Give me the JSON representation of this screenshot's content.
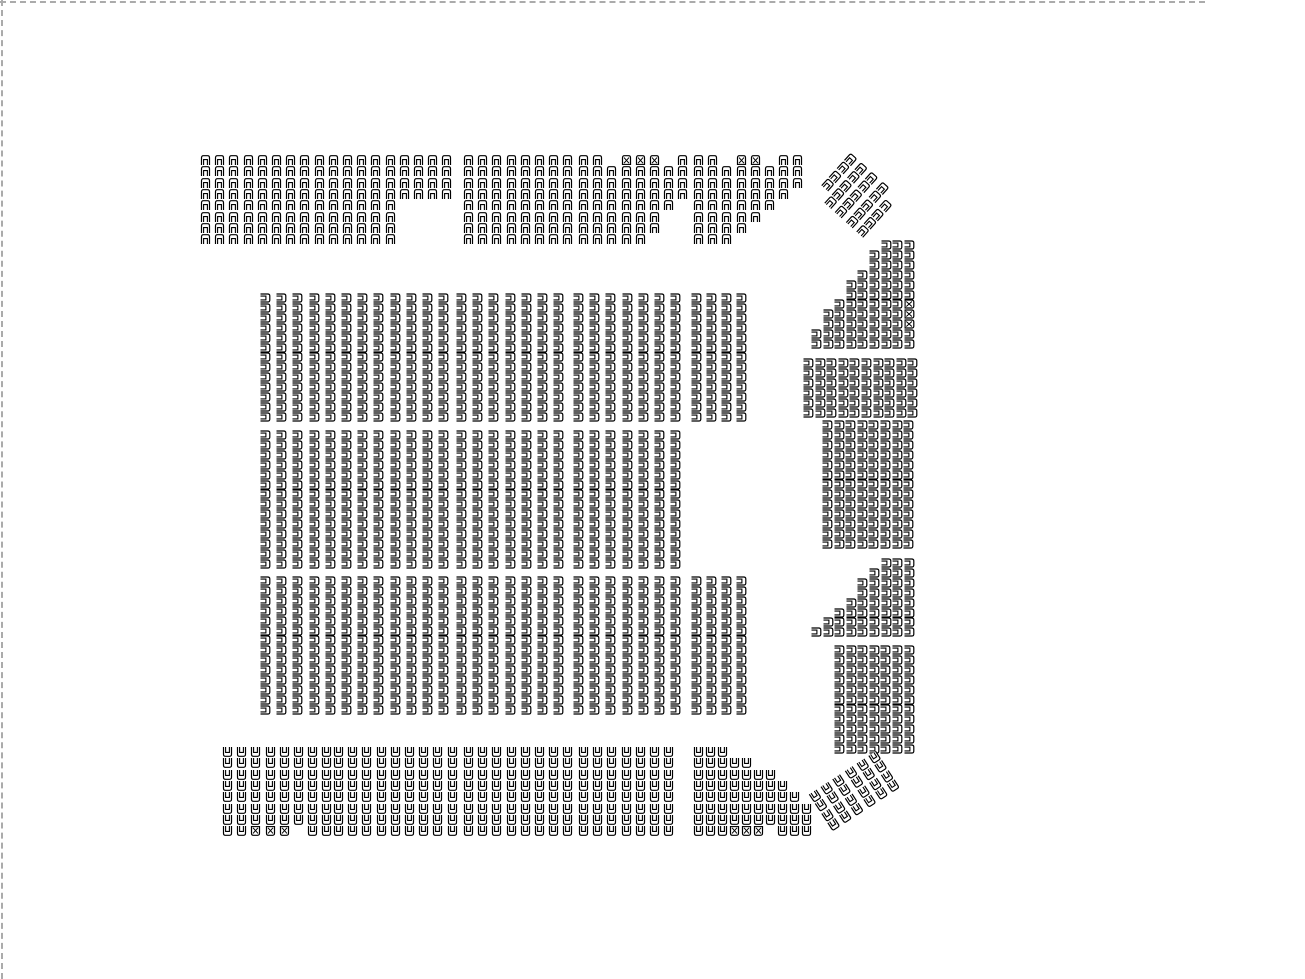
{
  "page": {
    "title": "Venue seating map",
    "background": "#ffffff",
    "boundary_style": "dashed",
    "boundary_color": "#ababab"
  },
  "icons": {
    "seat": "seat-icon",
    "wheelchair_seat": "wheelchair-seat-icon"
  },
  "seat_style": {
    "stroke": "#000000",
    "fill": "#ffffff",
    "width": 11,
    "height": 10
  },
  "legend": {
    "N": "standard-seat",
    "W": "restricted-or-accessible-seat",
    ".": "empty-space"
  },
  "sections": [
    {
      "id": "upper-left",
      "orientation": "down",
      "x": 200,
      "y": 155,
      "colSpacing": 14.2,
      "rowSpacing": 11.3,
      "rows": [
        "NNNNNNNNNNNNNNNNNN",
        "NNNNNNNNNNNNNNNNNN",
        "NNNNNNNNNNNNNNNNNN",
        "NNNNNNNNNNNNNNNNNN",
        "NNNNNNNNNNNNNN",
        "NNNNNNNNNNNNNN",
        "NNNNNNNNNNNNNN",
        "NNNNNNNNNNNNNN"
      ]
    },
    {
      "id": "upper-center",
      "orientation": "down",
      "x": 463,
      "y": 155,
      "colSpacing": 14.2,
      "rowSpacing": 11.3,
      "rows": [
        "NNNNNNNN",
        "NNNNNNNN",
        "NNNNNNNN",
        "NNNNNNNN",
        "NNNNNNNN",
        "NNNNNNNN",
        "NNNNNNNN",
        "NNNNNNNN"
      ]
    },
    {
      "id": "upper-right-a",
      "orientation": "down",
      "x": 578,
      "y": 155,
      "colSpacing": 14.2,
      "rowSpacing": 11.3,
      "rows": [
        "NN.WWW.N",
        "NNNNNNNN",
        "NNNNNNNN",
        "NNNNNNNN",
        "NNNNNNN.",
        "NNNNNN..",
        "NNNNNN..",
        "NNNNN..."
      ]
    },
    {
      "id": "upper-right-b",
      "orientation": "down",
      "x": 693,
      "y": 155,
      "colSpacing": 14.2,
      "rowSpacing": 11.3,
      "rows": [
        "NN.WW.NN",
        "NNNNNNNN",
        "NNNNNNNN",
        "NNNNNNN.",
        "NNNNNN..",
        "NNNNN...",
        "NNNN....",
        "NNN....."
      ]
    },
    {
      "id": "upper-corner-diagonal",
      "orientation": "down",
      "x": 850,
      "y": 152,
      "rotate": 42,
      "colSpacing": 14.2,
      "rowSpacing": 11.3,
      "rows": [
        "NNNN.",
        "NNNNN",
        "NNNNN",
        "NNNNN",
        ".NNNN"
      ]
    },
    {
      "id": "right-tier-1",
      "orientation": "left",
      "x": 811,
      "y": 240,
      "colSpacing": 11.6,
      "rowSpacing": 9.9,
      "rows": [
        "......NNN",
        ".....NNNN",
        ".....NNNN",
        "....NNNNN",
        "...NNNNNN",
        "...NNNNNN",
        "..NNNNNNW",
        ".NNNNNNNW",
        ".NNNNNNNW",
        "NNNNNNNNN",
        "NNNNNNNNN"
      ]
    },
    {
      "id": "right-tier-2",
      "orientation": "left",
      "x": 803,
      "y": 358,
      "colSpacing": 11.6,
      "rowSpacing": 9.9,
      "rows": [
        "NNNNNNNNNN",
        "NNNNNNNNNN",
        "NNNNNNNNNN",
        "NNNNNNNNNN",
        "NNNNNNNNNN",
        "NNNNNNNNNN"
      ]
    },
    {
      "id": "right-tier-3",
      "orientation": "left",
      "x": 822,
      "y": 420,
      "colSpacing": 11.6,
      "rowSpacing": 9.9,
      "rows": [
        "NNNNNNNN",
        "NNNNNNNN",
        "NNNNNNNN",
        "NNNNNNNN",
        "NNNNNNNN",
        "NNNNNNNN",
        "NNNNNNNN",
        "NNNNNNNN",
        "NNNNNNNN",
        "NNNNNNNN",
        "NNNNNNNN",
        "NNNNNNNN",
        "NNNNNNNN"
      ]
    },
    {
      "id": "right-tier-4",
      "orientation": "left",
      "x": 811,
      "y": 558,
      "colSpacing": 11.6,
      "rowSpacing": 9.9,
      "rows": [
        "......NNN",
        ".....NNNN",
        "....NNNNN",
        "....NNNNN",
        "...NNNNNN",
        "..NNNNNNN",
        ".NNNNNNNN",
        "NNNNNNNNN"
      ]
    },
    {
      "id": "right-tier-5",
      "orientation": "left",
      "x": 834,
      "y": 645,
      "colSpacing": 11.6,
      "rowSpacing": 9.9,
      "rows": [
        "NNNNNNN",
        "NNNNNNN",
        "NNNNNNN",
        "NNNNNNN",
        "NNNNNNN",
        "NNNNNNN",
        "NNNNNNN",
        "NNNNNNN",
        "NNNNNNN",
        "NNNNNNN",
        "NNNNNNN"
      ]
    },
    {
      "id": "floor-a1",
      "orientation": "left",
      "x": 260,
      "y": 293,
      "colSpacing": 16.2,
      "rowSpacing": 9.9,
      "rows": [
        "NNNNNNNNNNNN",
        "NNNNNNNNNNNN",
        "NNNNNNNNNNNN",
        "NNNNNNNNNNNN",
        "NNNNNNNNNNNN",
        "NNNNNNNNNNNN",
        "NNNNNNNNNNNN",
        "NNNNNNNNNNNN",
        "NNNNNNNNNNNN",
        "NNNNNNNNNNNN",
        "NNNNNNNNNNNN",
        "NNNNNNNNNNNN",
        "NNNNNNNNNNNN"
      ]
    },
    {
      "id": "floor-a2",
      "orientation": "left",
      "x": 456,
      "y": 293,
      "colSpacing": 16.2,
      "rowSpacing": 9.9,
      "rows": [
        "NNNNNNN",
        "NNNNNNN",
        "NNNNNNN",
        "NNNNNNN",
        "NNNNNNN",
        "NNNNNNN",
        "NNNNNNN",
        "NNNNNNN",
        "NNNNNNN",
        "NNNNNNN",
        "NNNNNNN",
        "NNNNNNN",
        "NNNNNNN"
      ]
    },
    {
      "id": "floor-a3",
      "orientation": "left",
      "x": 573,
      "y": 293,
      "colSpacing": 16.2,
      "rowSpacing": 9.9,
      "rows": [
        "NNNNNNN",
        "NNNNNNN",
        "NNNNNNN",
        "NNNNNNN",
        "NNNNNNN",
        "NNNNNNN",
        "NNNNNNN",
        "NNNNNNN",
        "NNNNNNN",
        "NNNNNNN",
        "NNNNNNN",
        "NNNNNNN",
        "NNNNNNN"
      ]
    },
    {
      "id": "floor-a4",
      "orientation": "left",
      "x": 691,
      "y": 293,
      "colSpacing": 15,
      "rowSpacing": 9.9,
      "rows": [
        "NNNN",
        "NNNN",
        "NNNN",
        "NNNN",
        "NNNN",
        "NNNN",
        "NNNN",
        "NNNN",
        "NNNN",
        "NNNN",
        "NNNN",
        "NNNN",
        "NNNN"
      ]
    },
    {
      "id": "floor-b1",
      "orientation": "left",
      "x": 260,
      "y": 430,
      "colSpacing": 16.2,
      "rowSpacing": 9.9,
      "rows": [
        "NNNNNNNNNNNN",
        "NNNNNNNNNNNN",
        "NNNNNNNNNNNN",
        "NNNNNNNNNNNN",
        "NNNNNNNNNNNN",
        "NNNNNNNNNNNN",
        "NNNNNNNNNNNN",
        "NNNNNNNNNNNN",
        "NNNNNNNNNNNN",
        "NNNNNNNNNNNN",
        "NNNNNNNNNNNN",
        "NNNNNNNNNNNN",
        "NNNNNNNNNNNN",
        "NNNNNNNNNNNN"
      ]
    },
    {
      "id": "floor-b2",
      "orientation": "left",
      "x": 456,
      "y": 430,
      "colSpacing": 16.2,
      "rowSpacing": 9.9,
      "rows": [
        "NNNNNNN",
        "NNNNNNN",
        "NNNNNNN",
        "NNNNNNN",
        "NNNNNNN",
        "NNNNNNN",
        "NNNNNNN",
        "NNNNNNN",
        "NNNNNNN",
        "NNNNNNN",
        "NNNNNNN",
        "NNNNNNN",
        "NNNNNNN",
        "NNNNNNN"
      ]
    },
    {
      "id": "floor-b3",
      "orientation": "left",
      "x": 573,
      "y": 430,
      "colSpacing": 16.2,
      "rowSpacing": 9.9,
      "rows": [
        "NNNNNNN",
        "NNNNNNN",
        "NNNNNNN",
        "NNNNNNN",
        "NNNNNNN",
        "NNNNNNN",
        "NNNNNNN",
        "NNNNNNN",
        "NNNNNNN",
        "NNNNNNN",
        "NNNNNNN",
        "NNNNNNN",
        "NNNNNNN",
        "NNNNNNN"
      ]
    },
    {
      "id": "floor-c1",
      "orientation": "left",
      "x": 260,
      "y": 576,
      "colSpacing": 16.2,
      "rowSpacing": 9.9,
      "rows": [
        "NNNNNNNNNNNN",
        "NNNNNNNNNNNN",
        "NNNNNNNNNNNN",
        "NNNNNNNNNNNN",
        "NNNNNNNNNNNN",
        "NNNNNNNNNNNN",
        "NNNNNNNNNNNN",
        "NNNNNNNNNNNN",
        "NNNNNNNNNNNN",
        "NNNNNNNNNNNN",
        "NNNNNNNNNNNN",
        "NNNNNNNNNNNN",
        "NNNNNNNNNNNN",
        "NNNNNNNNNNNN"
      ]
    },
    {
      "id": "floor-c2",
      "orientation": "left",
      "x": 456,
      "y": 576,
      "colSpacing": 16.2,
      "rowSpacing": 9.9,
      "rows": [
        "NNNNNNN",
        "NNNNNNN",
        "NNNNNNN",
        "NNNNNNN",
        "NNNNNNN",
        "NNNNNNN",
        "NNNNNNN",
        "NNNNNNN",
        "NNNNNNN",
        "NNNNNNN",
        "NNNNNNN",
        "NNNNNNN",
        "NNNNNNN",
        "NNNNNNN"
      ]
    },
    {
      "id": "floor-c3",
      "orientation": "left",
      "x": 573,
      "y": 576,
      "colSpacing": 16.2,
      "rowSpacing": 9.9,
      "rows": [
        "NNNNNNN",
        "NNNNNNN",
        "NNNNNNN",
        "NNNNNNN",
        "NNNNNNN",
        "NNNNNNN",
        "NNNNNNN",
        "NNNNNNN",
        "NNNNNNN",
        "NNNNNNN",
        "NNNNNNN",
        "NNNNNNN",
        "NNNNNNN",
        "NNNNNNN"
      ]
    },
    {
      "id": "floor-c4",
      "orientation": "left",
      "x": 691,
      "y": 576,
      "colSpacing": 15,
      "rowSpacing": 9.9,
      "rows": [
        "NNNN",
        "NNNN",
        "NNNN",
        "NNNN",
        "NNNN",
        "NNNN",
        "NNNN",
        "NNNN",
        "NNNN",
        "NNNN",
        "NNNN",
        "NNNN",
        "NNNN",
        "NNNN"
      ]
    },
    {
      "id": "lower-left",
      "orientation": "up",
      "x": 222,
      "y": 747,
      "colSpacing": 14.2,
      "rowSpacing": 11.3,
      "rows": [
        "NNNNNNNN",
        "NNNNNNNN",
        "NNNNNNNN",
        "NNNNNNNN",
        "NNNNNNNN",
        "NNNNNNNN",
        "NNNNNNNN",
        "NNWWW.NN"
      ]
    },
    {
      "id": "lower-center-a",
      "orientation": "up",
      "x": 333,
      "y": 747,
      "colSpacing": 14.2,
      "rowSpacing": 11.3,
      "rows": [
        "NNNNNNNNN",
        "NNNNNNNNN",
        "NNNNNNNNN",
        "NNNNNNNNN",
        "NNNNNNNNN",
        "NNNNNNNNN",
        "NNNNNNNNN",
        "NNNNNNNNN"
      ]
    },
    {
      "id": "lower-center-b",
      "orientation": "up",
      "x": 463,
      "y": 747,
      "colSpacing": 14.2,
      "rowSpacing": 11.3,
      "rows": [
        "NNNNNNNN",
        "NNNNNNNN",
        "NNNNNNNN",
        "NNNNNNNN",
        "NNNNNNNN",
        "NNNNNNNN",
        "NNNNNNNN",
        "NNNNNNNN"
      ]
    },
    {
      "id": "lower-center-c",
      "orientation": "up",
      "x": 578,
      "y": 747,
      "colSpacing": 14.2,
      "rowSpacing": 11.3,
      "rows": [
        "NNNNNNN",
        "NNNNNNN",
        "NNNNNNN",
        "NNNNNNN",
        "NNNNNNN",
        "NNNNNNN",
        "NNNNNNN",
        "NNNNNNN"
      ]
    },
    {
      "id": "lower-right-wedge",
      "orientation": "up",
      "x": 693,
      "y": 747,
      "colSpacing": 12,
      "rowSpacing": 11.3,
      "rows": [
        "NNN.......",
        "NNNNN.....",
        "NNNNNNN...",
        "NNNNNNNN..",
        "NNNNNNNNN.",
        "NNNNNNNNNN",
        "NNNNNNNNNN",
        "NNNWWW.NNN"
      ]
    },
    {
      "id": "lower-corner-diagonal",
      "orientation": "up",
      "x": 808,
      "y": 795,
      "rotate": -33,
      "colSpacing": 14.2,
      "rowSpacing": 11.3,
      "rows": [
        "NNNNNN",
        "NNNNNN",
        "NNNNNN",
        "NNNNNN"
      ]
    }
  ]
}
